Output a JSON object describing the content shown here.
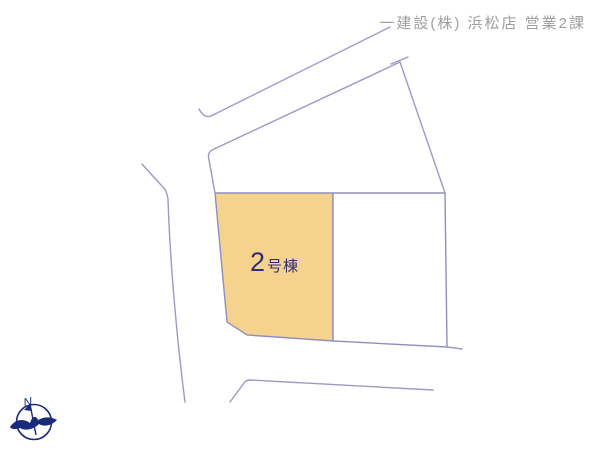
{
  "header": {
    "company": "一建設(株) 浜松店 営業2課"
  },
  "plot": {
    "label": "2号棟",
    "number": "2",
    "suffix": "号棟"
  },
  "compass": {
    "north_label": "N"
  },
  "colors": {
    "background": "#ffffff",
    "line": "#9a9ac8",
    "plot_fill": "#f6d28f",
    "plot_border": "#8f8fbe",
    "plot_label_text": "#2e2e78",
    "header_text": "#9e9e9e",
    "compass": "#1b2a7b"
  }
}
